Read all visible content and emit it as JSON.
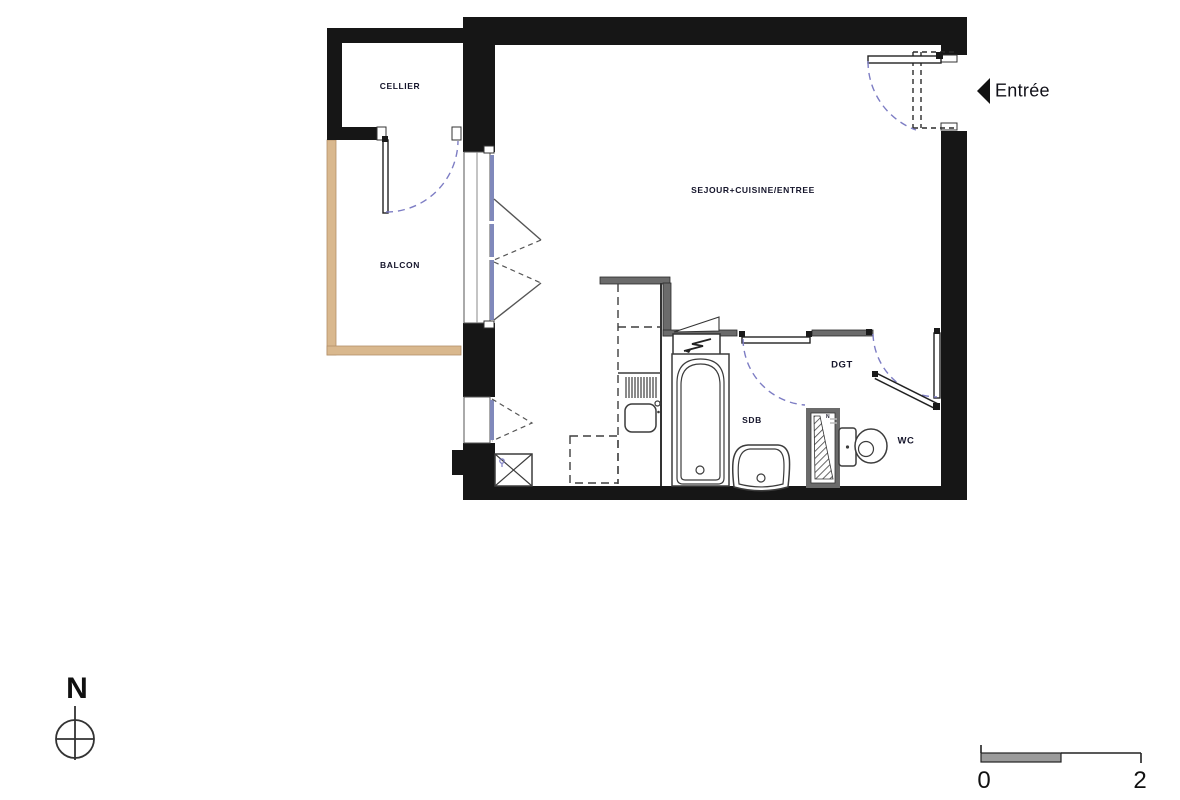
{
  "rooms": {
    "cellier": "CELLIER",
    "balcon": "BALCON",
    "sejour": "SEJOUR+CUISINE/ENTREE",
    "dgt": "DGT",
    "sdb": "SDB",
    "wc": "WC"
  },
  "entrance": {
    "label": "Entrée"
  },
  "north": {
    "label": "N"
  },
  "duct": {
    "label": "N"
  },
  "scale_bar": {
    "start": "0",
    "end": "2"
  },
  "colors": {
    "wall": "#161616",
    "partition": "#6b6b6b",
    "balcony": "#d9b88e",
    "glazing": "#8089bb",
    "door_swing": "#7d7dc4",
    "label_text": "#15152b",
    "fixture": "#3c3c3c"
  }
}
